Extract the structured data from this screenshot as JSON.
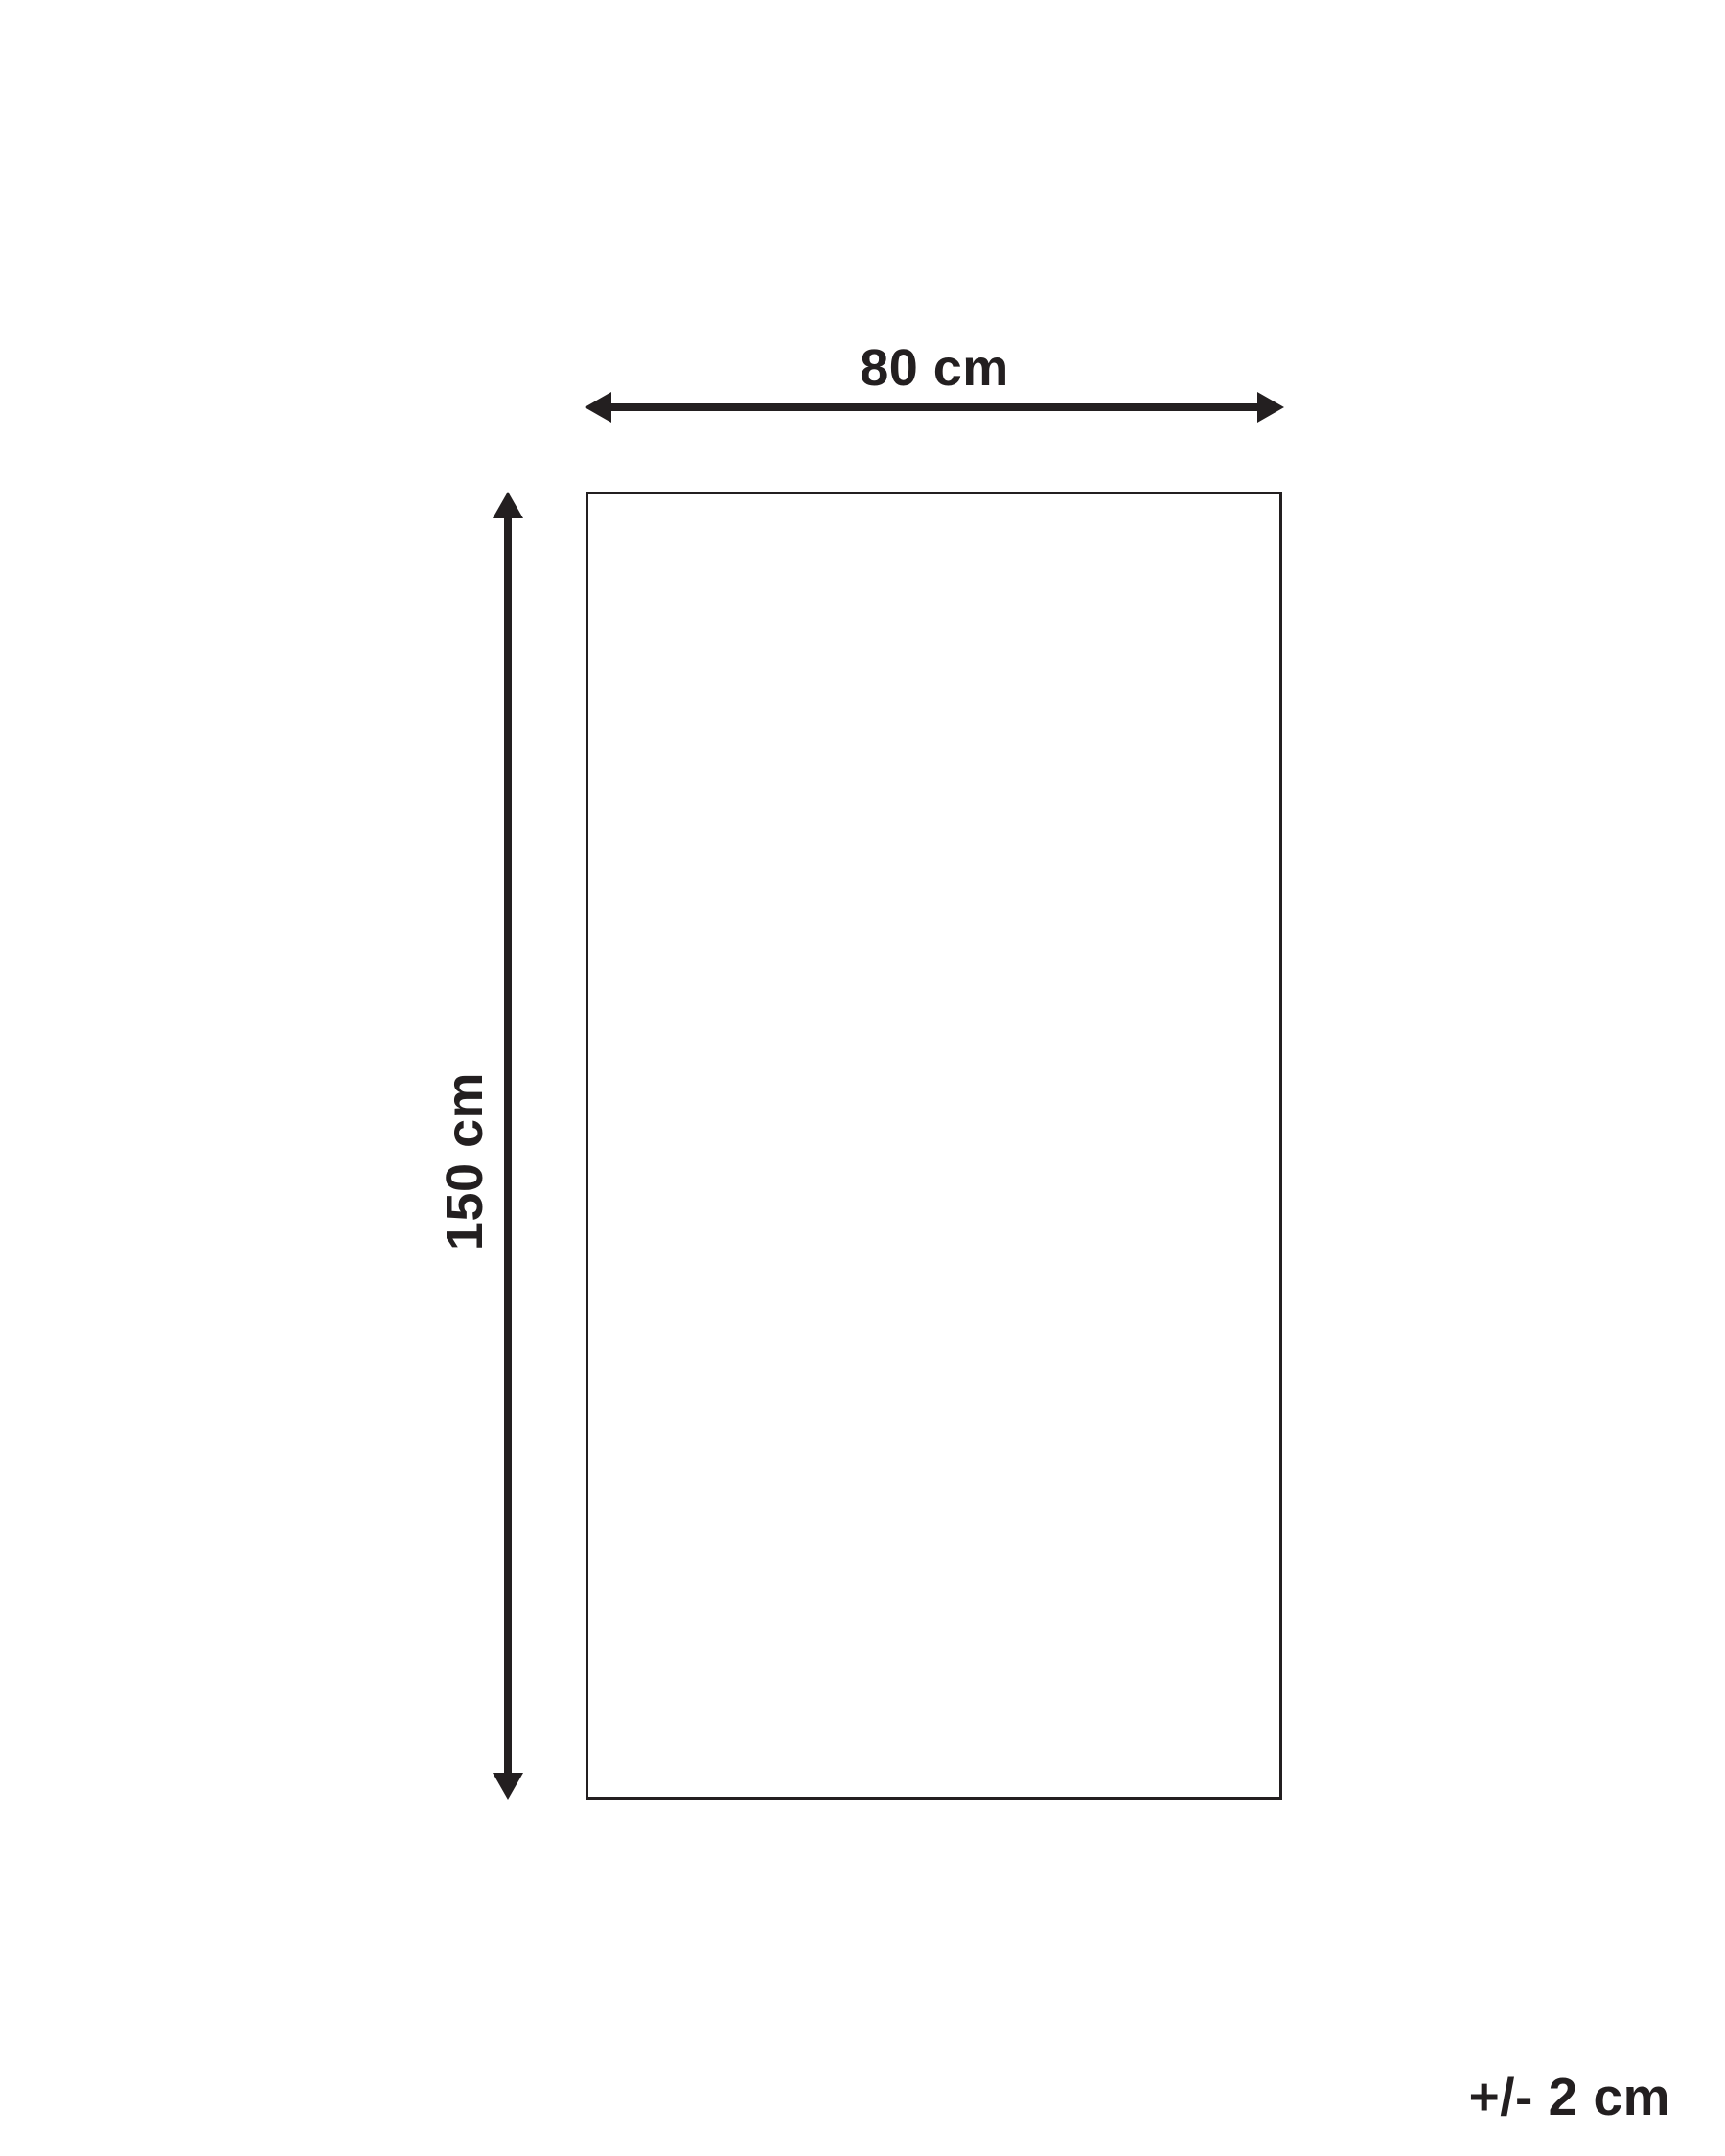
{
  "diagram": {
    "type": "product-dimension-diagram",
    "width_label": "80 cm",
    "height_label": "150 cm",
    "tolerance_label": "+/- 2 cm",
    "colors": {
      "ink": "#231f20",
      "background": "#ffffff"
    }
  }
}
